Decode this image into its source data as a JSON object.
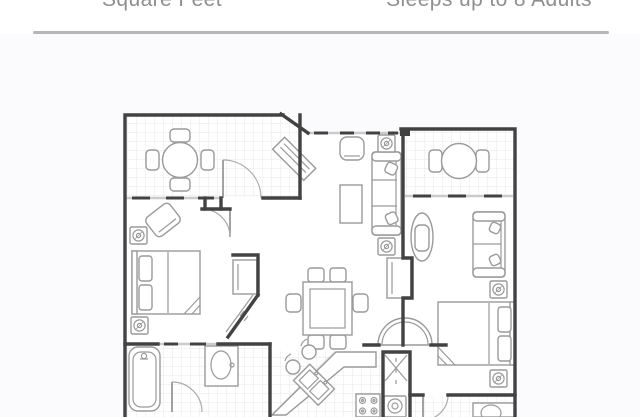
{
  "header": {
    "left_label": "Square Feet",
    "right_label": "Sleeps up to 8 Adults",
    "text_color": "#8f8f8f"
  },
  "divider": {
    "color": "#b6b6b8"
  },
  "section": {
    "background": "#fbfafc"
  },
  "floor_plan": {
    "description": "Two-bedroom lock-off villa floor plan drawing",
    "wall_color": "#424242",
    "furniture_color": "#9a9a9a",
    "grid_color": "#e7e7e9",
    "window_color": "#cbcbcb",
    "paper_color": "#ffffff",
    "rooms": [
      "balcony",
      "dining-balcony",
      "living-room",
      "master-bedroom",
      "master-bathroom",
      "kitchen",
      "laundry-closet",
      "studio-suite",
      "studio-bathroom"
    ]
  }
}
